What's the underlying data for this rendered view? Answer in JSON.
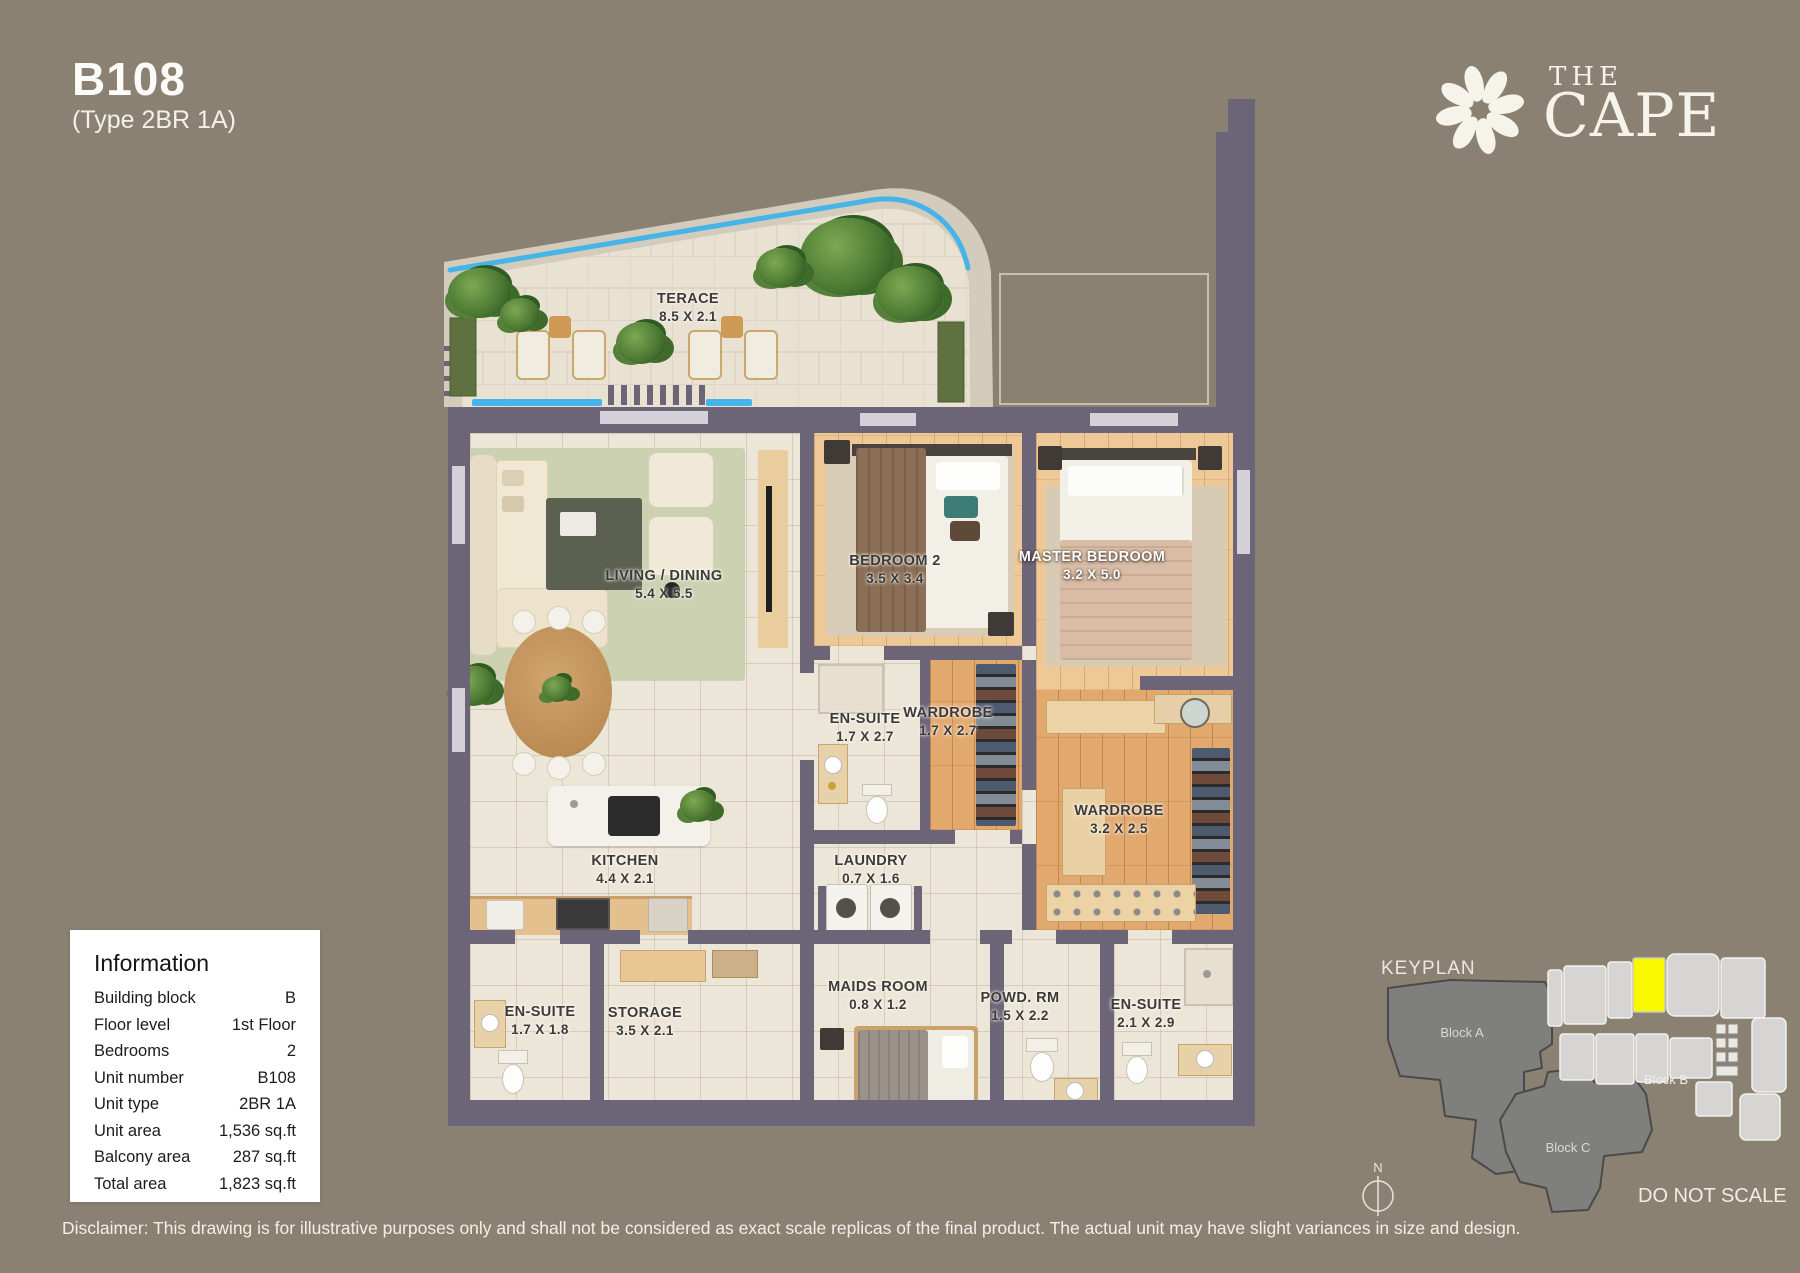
{
  "header": {
    "unit": "B108",
    "type": "(Type 2BR 1A)"
  },
  "brand": {
    "the": "THE",
    "cape": "CAPE"
  },
  "rooms": [
    {
      "name": "TERACE",
      "dims": "8.5 X 2.1"
    },
    {
      "name": "LIVING / DINING",
      "dims": "5.4 X 5.5"
    },
    {
      "name": "BEDROOM 2",
      "dims": "3.5 X 3.4"
    },
    {
      "name": "MASTER BEDROOM",
      "dims": "3.2 X 5.0"
    },
    {
      "name": "EN-SUITE",
      "dims": "1.7 X 2.7"
    },
    {
      "name": "WARDROBE",
      "dims": "1.7 X 2.7"
    },
    {
      "name": "WARDROBE",
      "dims": "3.2 X 2.5"
    },
    {
      "name": "KITCHEN",
      "dims": "4.4 X 2.1"
    },
    {
      "name": "LAUNDRY",
      "dims": "0.7 X 1.6"
    },
    {
      "name": "EN-SUITE",
      "dims": "1.7 X 1.8"
    },
    {
      "name": "STORAGE",
      "dims": "3.5 X 2.1"
    },
    {
      "name": "MAIDS ROOM",
      "dims": "0.8 X 1.2"
    },
    {
      "name": "POWD. RM",
      "dims": "1.5 X 2.2"
    },
    {
      "name": "EN-SUITE",
      "dims": "2.1 X 2.9"
    }
  ],
  "info": {
    "title": "Information",
    "rows": [
      {
        "label": "Building block",
        "value": "B"
      },
      {
        "label": "Floor level",
        "value": "1st Floor"
      },
      {
        "label": "Bedrooms",
        "value": "2"
      },
      {
        "label": "Unit number",
        "value": "B108"
      },
      {
        "label": "Unit type",
        "value": "2BR 1A"
      },
      {
        "label": "Unit area",
        "value": "1,536 sq.ft"
      },
      {
        "label": "Balcony area",
        "value": "287 sq.ft"
      },
      {
        "label": "Total area",
        "value": "1,823 sq.ft"
      }
    ]
  },
  "keyplan": {
    "title": "KEYPLAN",
    "block_a": "Block A",
    "block_b": "Block B",
    "block_c": "Block C",
    "compass": "N",
    "note": "DO NOT SCALE",
    "highlight": "#f8f800"
  },
  "disclaimer": "Disclaimer: This drawing is for illustrative purposes only and shall not be considered as exact scale replicas of the final product. The actual unit may have slight variances in size and design.",
  "colors": {
    "background": "#8b8173",
    "wall": "#6c6577",
    "pool": "#45b4e8",
    "floor": "#ece6d8",
    "wood": "#e8bd8d",
    "highlight": "#f8f800"
  }
}
